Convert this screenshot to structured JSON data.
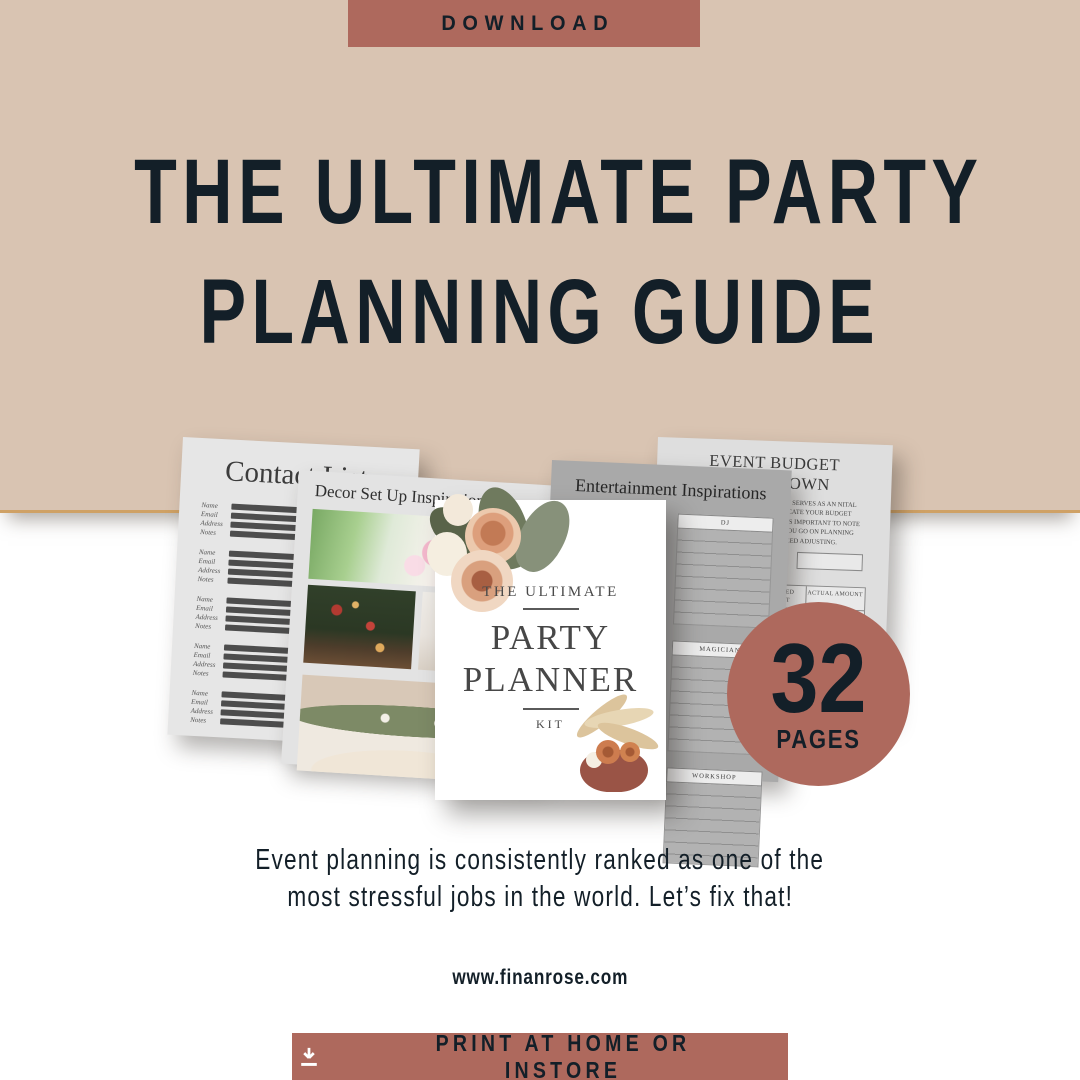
{
  "colors": {
    "accent": "#ae695d",
    "header_bg": "#d9c4b2",
    "header_rule": "#cfa165",
    "ink": "#131f28"
  },
  "header": {
    "download_label": "DOWNLOAD",
    "title_line1": "THE ULTIMATE PARTY",
    "title_line2": "PLANNING GUIDE"
  },
  "mockup": {
    "contact_page": {
      "title": "Contact List",
      "field_labels": [
        "Name",
        "Email",
        "Address",
        "Notes"
      ]
    },
    "decor_page": {
      "title": "Decor Set Up Inspiration"
    },
    "cover_page": {
      "eyebrow": "THE ULTIMATE",
      "title_line1": "PARTY",
      "title_line2": "PLANNER",
      "subtitle": "KIT"
    },
    "entertainment_page": {
      "title": "Entertainment Inspirations",
      "sections": [
        "DJ",
        "MAGICIAN",
        "WORKSHOP"
      ]
    },
    "budget_page": {
      "title": "EVENT BUDGET BREAKDOWN",
      "intro": "A ROUGH BUDGET BREAKDOWN SERVES AS AN NITAL ESTIMATE TO HELP YOU ALLOCATE YOUR BUDGET AMONG THE SPECIFIC EVENT. IT IS IMPORTANT TO NOTE THESE ARE PRELIMINARY. AS YOU GO ON PLANNING THESE ESTAMTES WILL NEED ADJUSTING.",
      "budget_label": "SPENDING BUDGET",
      "balance_label": "BALANCE",
      "table_headers": [
        "PROJECTED AMOUNT",
        "ACTUAL AMOUNT"
      ]
    }
  },
  "pages_badge": {
    "number": "32",
    "label": "PAGES"
  },
  "tagline": {
    "line1": "Event planning is consistently ranked as one of the",
    "line2": "most stressful jobs in the world. Let’s fix that!"
  },
  "website": "www.finanrose.com",
  "cta": {
    "label": "PRINT AT HOME OR INSTORE",
    "icon": "download-icon"
  }
}
